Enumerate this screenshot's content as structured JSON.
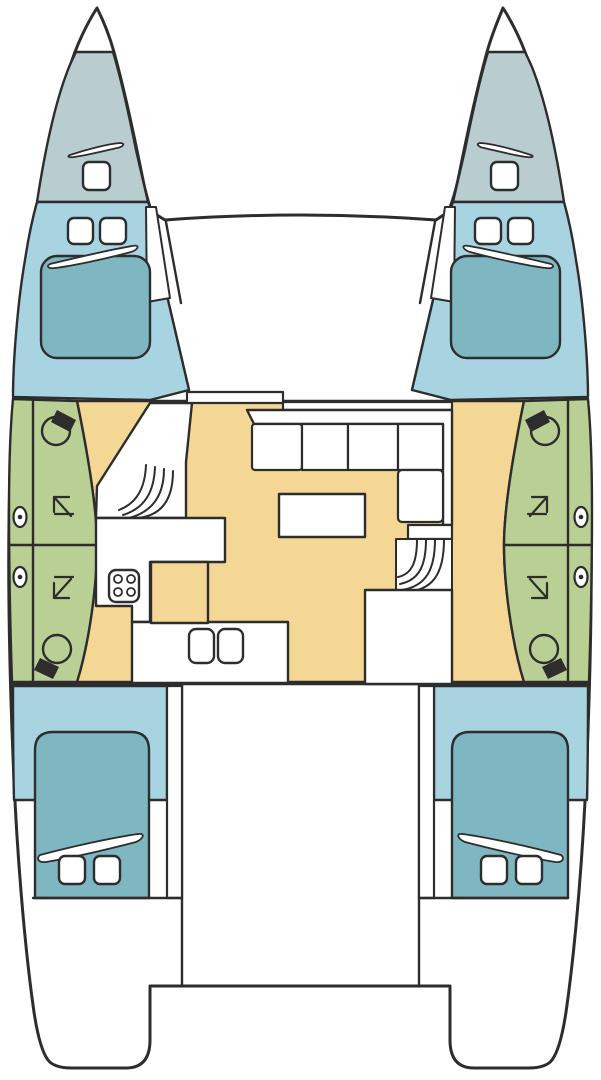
{
  "canvas": {
    "width": 601,
    "height": 1080,
    "background": "#ffffff"
  },
  "palette": {
    "line": "#2d2d2d",
    "white": "#ffffff",
    "forepeak": "#b9cdd1",
    "cabin": "#a8d4e2",
    "bed": "#7eb6c1",
    "head": "#b9cf93",
    "floor": "#f4d795"
  },
  "shapes": [
    {
      "name": "hull-silhouette",
      "kind": "path",
      "fill": "white",
      "sw": 3,
      "d": "M97,8 C88,22 76,45 69,70 C55,115 38,190 25,280 C16,345 10,430 9,520 C8,600 10,690 14,780 C17,850 24,940 33,1005 C37,1035 42,1052 48,1060 Q54,1068 72,1068 L126,1068 Q150,1068 150,1040 L150,986 L450,986 L450,1040 Q450,1068 474,1068 L528,1068 Q546,1068 552,1060 C558,1052 563,1035 567,1005 C576,940 583,850 586,780 C590,690 592,600 591,520 C590,430 584,345 575,280 C562,190 545,115 531,70 C524,45 512,22 503,8 C498,20 492,34 487,52 C478,85 468,130 459,175 C455,195 450,208 448,212 L436,220 Q300,210 165,220 L152,212 C150,208 146,195 142,175 C133,130 123,85 114,52 C109,34 103,20 97,8 Z"
    },
    {
      "name": "deck-edge-left-outer",
      "kind": "path",
      "d": "M152,214 L168,300 L189,390"
    },
    {
      "name": "deck-edge-left-inner",
      "kind": "path",
      "d": "M166,222 L181,303"
    },
    {
      "name": "deck-edge-right-outer",
      "kind": "path",
      "d": "M448,214 L433,300 L412,390"
    },
    {
      "name": "deck-edge-right-inner",
      "kind": "path",
      "d": "M435,222 L420,303"
    },
    {
      "name": "salon-floor",
      "kind": "path",
      "fill": "floor",
      "d": "M77,401 L524,401 C513,455 504,510 504,545 C504,582 511,640 524,682 L77,682 C90,640 97,582 97,545 C97,510 88,455 77,401 Z"
    },
    {
      "name": "forepeak-port",
      "kind": "path",
      "fill": "forepeak",
      "d": "M76,52 L113,52 C120,75 128,110 136,150 L148,202 L37,202 C45,150 55,105 66,75 C69,66 73,58 76,52 Z"
    },
    {
      "name": "forepeak-starboard",
      "kind": "path",
      "fill": "forepeak",
      "d": "M525,52 L488,52 C481,75 473,110 465,150 L453,202 L564,202 C556,150 546,105 535,75 C532,66 528,58 525,52 Z"
    },
    {
      "name": "forepeak-hatch-port",
      "kind": "rect",
      "x": 83,
      "y": 162,
      "w": 27,
      "h": 28,
      "rx": 6,
      "fill": "white",
      "sw": 2.4
    },
    {
      "name": "forepeak-hatch-starboard",
      "kind": "rect",
      "x": 491,
      "y": 162,
      "w": 27,
      "h": 28,
      "rx": 6,
      "fill": "white",
      "sw": 2.4
    },
    {
      "name": "forepeak-vent-port",
      "kind": "path",
      "fill": "white",
      "sw": 1.8,
      "d": "M70,155 C88,149 108,144 120,143 C126,143 123,147 117,148 C100,152 84,156 74,157 C68,158 67,156 70,155 Z"
    },
    {
      "name": "forepeak-vent-starboard",
      "kind": "path",
      "fill": "white",
      "sw": 1.8,
      "d": "M531,155 C513,149 493,144 481,143 C475,143 478,147 484,148 C501,152 517,156 527,157 C533,158 534,156 531,155 Z"
    },
    {
      "name": "fwd-cabin-port",
      "kind": "path",
      "fill": "cabin",
      "d": "M37,202 L148,202 C151,210 152,214 154,220 L168,300 L189,390 L150,400 L13,397 C13,360 18,300 25,260 C28,240 32,220 37,202 Z"
    },
    {
      "name": "fwd-cabin-starboard",
      "kind": "path",
      "fill": "cabin",
      "d": "M564,202 L453,202 C450,210 449,214 447,220 L433,300 L412,390 L451,400 L588,397 C588,360 583,300 576,260 C573,240 569,220 564,202 Z"
    },
    {
      "name": "sidedeck-wedge-port",
      "kind": "path",
      "fill": "white",
      "sw": 2,
      "d": "M146,207 L156,207 L170,298 L147,302 Z"
    },
    {
      "name": "sidedeck-wedge-starboard",
      "kind": "path",
      "fill": "white",
      "sw": 2,
      "d": "M455,207 L445,207 L431,298 L454,302 Z"
    },
    {
      "name": "fwd-bed-port",
      "kind": "rect",
      "x": 41,
      "y": 256,
      "w": 109,
      "h": 102,
      "rx": 16,
      "fill": "bed",
      "sw": 2.4
    },
    {
      "name": "fwd-bed-starboard",
      "kind": "rect",
      "x": 451,
      "y": 256,
      "w": 109,
      "h": 102,
      "rx": 16,
      "fill": "bed",
      "sw": 2.4
    },
    {
      "name": "fwd-hatch-port-1",
      "kind": "rect",
      "x": 68,
      "y": 218,
      "w": 25,
      "h": 26,
      "rx": 6,
      "fill": "white",
      "sw": 2.4
    },
    {
      "name": "fwd-hatch-port-2",
      "kind": "rect",
      "x": 100,
      "y": 218,
      "w": 26,
      "h": 26,
      "rx": 6,
      "fill": "white",
      "sw": 2.4
    },
    {
      "name": "fwd-hatch-starboard-1",
      "kind": "rect",
      "x": 475,
      "y": 218,
      "w": 26,
      "h": 26,
      "rx": 6,
      "fill": "white",
      "sw": 2.4
    },
    {
      "name": "fwd-hatch-starboard-2",
      "kind": "rect",
      "x": 508,
      "y": 218,
      "w": 25,
      "h": 26,
      "rx": 6,
      "fill": "white",
      "sw": 2.4
    },
    {
      "name": "fwd-pillow-port",
      "kind": "path",
      "fill": "white",
      "sw": 1.8,
      "d": "M50,264 C75,258 115,249 132,246 C141,244 138,250 131,252 C105,259 72,266 55,268 C48,269 46,266 50,264 Z"
    },
    {
      "name": "fwd-pillow-starboard",
      "kind": "path",
      "fill": "white",
      "sw": 1.8,
      "d": "M551,264 C526,258 486,249 469,246 C460,244 463,250 470,252 C496,259 529,266 546,268 C553,269 555,266 551,264 Z"
    },
    {
      "name": "head-compartment-port",
      "kind": "path",
      "fill": "head",
      "d": "M13,399 L77,401 C88,455 97,510 97,545 C97,582 90,640 77,682 L12,682 C10,620 9,560 9,510 C9,470 10,430 13,399 Z"
    },
    {
      "name": "head-compartment-starboard",
      "kind": "path",
      "fill": "head",
      "d": "M588,399 L524,401 C513,455 504,510 504,545 C504,582 511,640 524,682 L589,682 C591,620 592,560 592,510 C592,470 591,430 588,399 Z"
    },
    {
      "name": "head-divider-port-vertical",
      "kind": "path",
      "d": "M33,400 L33,682"
    },
    {
      "name": "head-divider-port-horizontal",
      "kind": "path",
      "d": "M10,545 L96,545"
    },
    {
      "name": "head-divider-starboard-vertical",
      "kind": "path",
      "d": "M568,400 L568,682"
    },
    {
      "name": "head-divider-starboard-horizontal",
      "kind": "path",
      "d": "M505,545 L591,545"
    },
    {
      "name": "toilet-fwd-port-bowl",
      "kind": "circle",
      "cx": 56,
      "cy": 431,
      "r": 14,
      "sw": 2.4
    },
    {
      "name": "toilet-fwd-port-tank",
      "kind": "path",
      "fill": "line",
      "stroke": null,
      "d": "M57,410 L76,420 L70,432 L51,422 Z"
    },
    {
      "name": "toilet-aft-port-bowl",
      "kind": "circle",
      "cx": 57,
      "cy": 649,
      "r": 14,
      "sw": 2.4
    },
    {
      "name": "toilet-aft-port-tank",
      "kind": "path",
      "fill": "line",
      "stroke": null,
      "d": "M40,658 L59,667 L53,679 L34,670 Z"
    },
    {
      "name": "toilet-fwd-starboard-bowl",
      "kind": "circle",
      "cx": 545,
      "cy": 431,
      "r": 14,
      "sw": 2.4
    },
    {
      "name": "toilet-fwd-starboard-tank",
      "kind": "path",
      "fill": "line",
      "stroke": null,
      "d": "M544,410 L525,420 L531,432 L550,422 Z"
    },
    {
      "name": "toilet-aft-starboard-bowl",
      "kind": "circle",
      "cx": 544,
      "cy": 649,
      "r": 14,
      "sw": 2.4
    },
    {
      "name": "toilet-aft-starboard-tank",
      "kind": "path",
      "fill": "line",
      "stroke": null,
      "d": "M561,658 L542,667 L548,679 L567,670 Z"
    },
    {
      "name": "shower-arrow-fwd-port",
      "kind": "path",
      "sw": 2.2,
      "d": "M54,497 L71,516 M54,497 L54,512 M54,497 L69,497 M55,514 L73,514"
    },
    {
      "name": "shower-arrow-aft-port",
      "kind": "path",
      "sw": 2.2,
      "d": "M54,598 L71,579 M54,598 L54,583 M54,598 L69,598 M55,577 L73,577"
    },
    {
      "name": "shower-arrow-fwd-starboard",
      "kind": "path",
      "sw": 2.2,
      "d": "M547,497 L530,516 M547,497 L547,512 M547,497 L532,497 M528,514 L546,514"
    },
    {
      "name": "shower-arrow-aft-starboard",
      "kind": "path",
      "sw": 2.2,
      "d": "M547,598 L530,579 M547,598 L547,583 M547,598 L532,598 M528,577 L546,577"
    },
    {
      "name": "porthole-port-1",
      "kind": "ellipse",
      "cx": 20,
      "cy": 517,
      "rx": 6.5,
      "ry": 10,
      "fill": "white",
      "sw": 2.2
    },
    {
      "name": "porthole-port-1-dot",
      "kind": "circle",
      "cx": 20,
      "cy": 517,
      "r": 2.3,
      "fill": "line",
      "stroke": null
    },
    {
      "name": "porthole-port-2",
      "kind": "ellipse",
      "cx": 20,
      "cy": 577,
      "rx": 6.5,
      "ry": 10,
      "fill": "white",
      "sw": 2.2
    },
    {
      "name": "porthole-port-2-dot",
      "kind": "circle",
      "cx": 20,
      "cy": 577,
      "r": 2.3,
      "fill": "line",
      "stroke": null
    },
    {
      "name": "porthole-starboard-1",
      "kind": "ellipse",
      "cx": 581,
      "cy": 517,
      "rx": 6.5,
      "ry": 10,
      "fill": "white",
      "sw": 2.2
    },
    {
      "name": "porthole-starboard-1-dot",
      "kind": "circle",
      "cx": 581,
      "cy": 517,
      "r": 2.3,
      "fill": "line",
      "stroke": null
    },
    {
      "name": "porthole-starboard-2",
      "kind": "ellipse",
      "cx": 581,
      "cy": 577,
      "rx": 6.5,
      "ry": 10,
      "fill": "white",
      "sw": 2.2
    },
    {
      "name": "porthole-starboard-2-dot",
      "kind": "circle",
      "cx": 581,
      "cy": 577,
      "r": 2.3,
      "fill": "line",
      "stroke": null
    },
    {
      "name": "cockpit-bulkhead-line",
      "kind": "path",
      "d": "M12,684 L589,684"
    },
    {
      "name": "inner-wall-port",
      "kind": "path",
      "d": "M182,685 L182,986"
    },
    {
      "name": "inner-wall-starboard",
      "kind": "path",
      "d": "M419,685 L419,986"
    },
    {
      "name": "aft-cabin-port",
      "kind": "path",
      "fill": "cabin",
      "d": "M13,686 L167,686 L167,800 L14,800 C13,763 13,725 13,686 Z"
    },
    {
      "name": "aft-cabin-starboard",
      "kind": "path",
      "fill": "cabin",
      "d": "M588,686 L434,686 L434,800 L587,800 C588,763 588,725 588,686 Z"
    },
    {
      "name": "aft-sidedeck-port",
      "kind": "rect",
      "x": 167,
      "y": 686,
      "w": 15,
      "h": 212,
      "fill": "white",
      "sw": 2.2
    },
    {
      "name": "aft-sidedeck-starboard",
      "kind": "rect",
      "x": 419,
      "y": 686,
      "w": 15,
      "h": 212,
      "fill": "white",
      "sw": 2.2
    },
    {
      "name": "aft-bed-port",
      "kind": "path",
      "fill": "bed",
      "sw": 2.4,
      "d": "M35,750 Q35,732 53,732 L131,732 Q149,732 149,750 L149,898 L35,898 Z"
    },
    {
      "name": "aft-bed-starboard",
      "kind": "path",
      "fill": "bed",
      "sw": 2.4,
      "d": "M452,750 Q452,732 470,732 L550,732 Q568,732 568,750 L568,898 L452,898 Z"
    },
    {
      "name": "aft-pillow-port",
      "kind": "path",
      "fill": "white",
      "sw": 1.8,
      "d": "M40,855 C70,847 110,838 138,834 C146,833 143,839 136,842 C105,850 70,858 46,862 C38,863 36,858 40,855 Z"
    },
    {
      "name": "aft-pillow-starboard",
      "kind": "path",
      "fill": "white",
      "sw": 1.8,
      "d": "M561,855 C531,847 491,838 463,834 C455,833 458,839 465,842 C496,850 531,858 555,862 C563,863 565,858 561,855 Z"
    },
    {
      "name": "aft-hatch-port-1",
      "kind": "rect",
      "x": 59,
      "y": 856,
      "w": 26,
      "h": 28,
      "rx": 6,
      "fill": "white",
      "sw": 2.4
    },
    {
      "name": "aft-hatch-port-2",
      "kind": "rect",
      "x": 94,
      "y": 856,
      "w": 26,
      "h": 28,
      "rx": 6,
      "fill": "white",
      "sw": 2.4
    },
    {
      "name": "aft-hatch-starboard-1",
      "kind": "rect",
      "x": 481,
      "y": 856,
      "w": 26,
      "h": 28,
      "rx": 6,
      "fill": "white",
      "sw": 2.4
    },
    {
      "name": "aft-hatch-starboard-2",
      "kind": "rect",
      "x": 516,
      "y": 856,
      "w": 26,
      "h": 28,
      "rx": 6,
      "fill": "white",
      "sw": 2.4
    },
    {
      "name": "stern-line-port",
      "kind": "path",
      "d": "M33,898 L182,898"
    },
    {
      "name": "stern-line-starboard",
      "kind": "path",
      "d": "M419,898 L568,898"
    },
    {
      "name": "companionway-port-walkway",
      "kind": "path",
      "fill": "white",
      "sw": 2.4,
      "d": "M150,403 L192,403 L186,462 L186,518 L96,518 L97,486 Z"
    },
    {
      "name": "stairs-port-treads",
      "kind": "path",
      "sw": 2,
      "d": "M146,465 C145,488 137,503 119,510 M155,467 C154,492 145,508 123,515 M164,469 C164,496 152,512 129,518 M173,471 C173,500 161,516 137,518"
    },
    {
      "name": "galley-counter",
      "kind": "path",
      "fill": "white",
      "sw": 2.4,
      "d": "M96,518 L225,518 L225,562 L150,562 L150,622 L132,622 L132,606 L96,606 Z"
    },
    {
      "name": "galley-bottom-counter",
      "kind": "rect",
      "x": 132,
      "y": 622,
      "w": 156,
      "h": 61,
      "fill": "white",
      "sw": 2.4
    },
    {
      "name": "galley-island",
      "kind": "rect",
      "x": 151,
      "y": 562,
      "w": 57,
      "h": 61,
      "fill": "floor",
      "sw": 2.4
    },
    {
      "name": "stove",
      "kind": "rect",
      "x": 109,
      "y": 570,
      "w": 30,
      "h": 32,
      "rx": 7,
      "fill": "white",
      "sw": 2.4
    },
    {
      "name": "stove-burner-1",
      "kind": "circle",
      "cx": 118,
      "cy": 579,
      "r": 4,
      "sw": 1.8
    },
    {
      "name": "stove-burner-2",
      "kind": "circle",
      "cx": 131,
      "cy": 579,
      "r": 4,
      "sw": 1.8
    },
    {
      "name": "stove-burner-3",
      "kind": "circle",
      "cx": 118,
      "cy": 592,
      "r": 4,
      "sw": 1.8
    },
    {
      "name": "stove-burner-4",
      "kind": "circle",
      "cx": 131,
      "cy": 592,
      "r": 4,
      "sw": 1.8
    },
    {
      "name": "sink-1",
      "kind": "rect",
      "x": 189,
      "y": 629,
      "w": 25,
      "h": 34,
      "rx": 7,
      "fill": "white",
      "sw": 2.4
    },
    {
      "name": "sink-2",
      "kind": "rect",
      "x": 218,
      "y": 629,
      "w": 25,
      "h": 34,
      "rx": 7,
      "fill": "white",
      "sw": 2.4
    },
    {
      "name": "salon-front-step-left",
      "kind": "rect",
      "x": 187,
      "y": 392,
      "w": 96,
      "h": 11,
      "fill": "white",
      "sw": 2.2
    },
    {
      "name": "salon-front-step-right",
      "kind": "rect",
      "x": 283,
      "y": 402,
      "w": 169,
      "h": 8,
      "fill": "white",
      "sw": 2.2
    },
    {
      "name": "sofa-backrest",
      "kind": "path",
      "fill": "white",
      "sw": 2.4,
      "d": "M247,410 L452,410 L452,525 L443,525 L443,424 L254,424 Z"
    },
    {
      "name": "sofa-cushion-1",
      "kind": "rect",
      "x": 252,
      "y": 424,
      "w": 50,
      "h": 46,
      "rx": 3,
      "fill": "white",
      "sw": 2.2
    },
    {
      "name": "sofa-cushion-2",
      "kind": "rect",
      "x": 302,
      "y": 424,
      "w": 46,
      "h": 46,
      "fill": "white",
      "sw": 2.2
    },
    {
      "name": "sofa-cushion-3",
      "kind": "rect",
      "x": 348,
      "y": 424,
      "w": 50,
      "h": 46,
      "fill": "white",
      "sw": 2.2
    },
    {
      "name": "sofa-cushion-4",
      "kind": "rect",
      "x": 398,
      "y": 424,
      "w": 45,
      "h": 46,
      "fill": "white",
      "sw": 2.2
    },
    {
      "name": "sofa-cushion-5",
      "kind": "rect",
      "x": 398,
      "y": 470,
      "w": 45,
      "h": 52,
      "rx": 4,
      "fill": "white",
      "sw": 2.2
    },
    {
      "name": "stairs-starboard-landing",
      "kind": "rect",
      "x": 408,
      "y": 525,
      "w": 44,
      "h": 14,
      "fill": "white",
      "sw": 2.2
    },
    {
      "name": "stairs-starboard-well",
      "kind": "rect",
      "x": 396,
      "y": 539,
      "w": 56,
      "h": 53,
      "fill": "white",
      "sw": 2
    },
    {
      "name": "stairs-starboard-treads",
      "kind": "path",
      "sw": 2,
      "d": "M417,539 C417,562 412,574 398,577 M426,539 C426,566 419,580 400,584 M435,539 C435,570 426,586 402,590 M444,539 C444,574 433,591 404,592"
    },
    {
      "name": "aft-door-opening",
      "kind": "rect",
      "x": 365,
      "y": 590,
      "w": 87,
      "h": 94,
      "fill": "white",
      "sw": 2.4
    },
    {
      "name": "salon-table",
      "kind": "rect",
      "x": 279,
      "y": 494,
      "w": 86,
      "h": 43,
      "fill": "white",
      "sw": 2.4
    }
  ]
}
